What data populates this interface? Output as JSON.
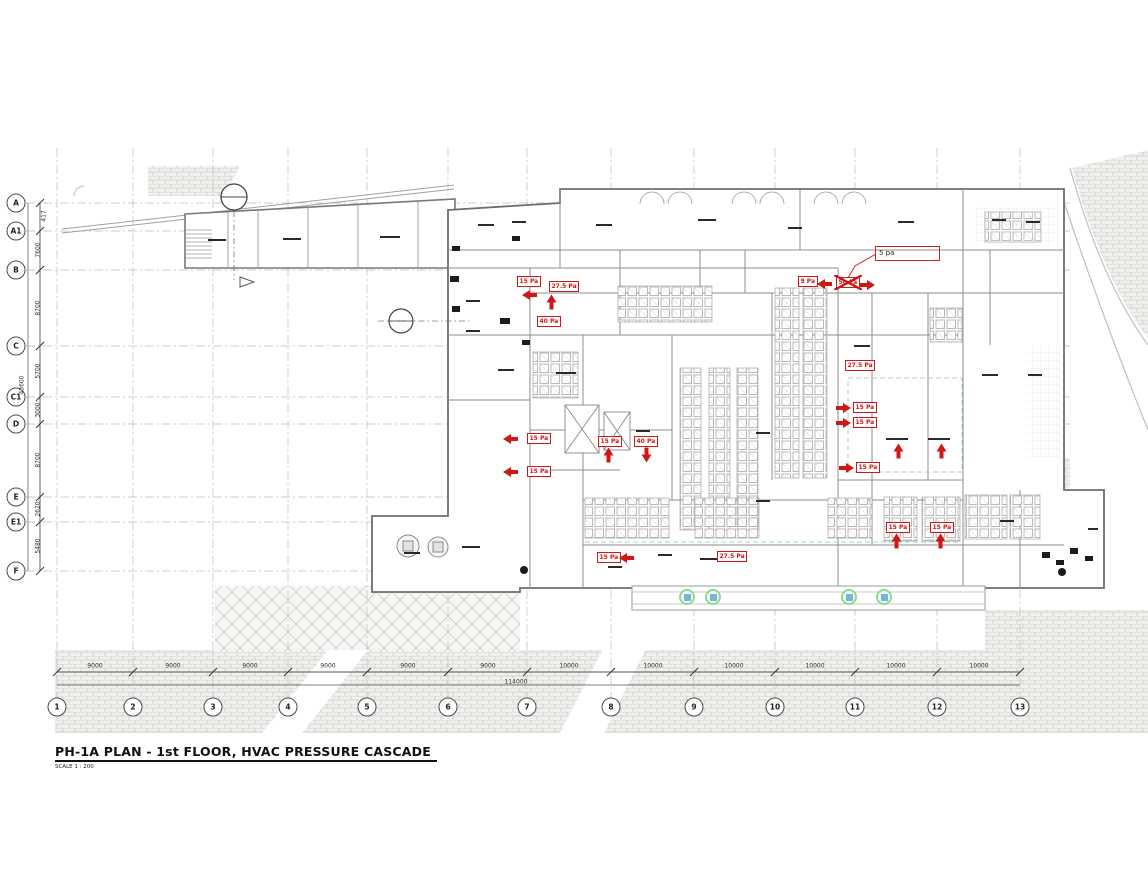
{
  "title": {
    "main": "PH-1A PLAN - 1st FLOOR, HVAC PRESSURE CASCADE",
    "scale": "SCALE 1 : 200"
  },
  "callout": {
    "text": "5 pa"
  },
  "grid": {
    "rows": [
      {
        "label": "A",
        "x": 16,
        "y": 203
      },
      {
        "label": "A1",
        "x": 16,
        "y": 231
      },
      {
        "label": "B",
        "x": 16,
        "y": 270
      },
      {
        "label": "C",
        "x": 16,
        "y": 346
      },
      {
        "label": "C1",
        "x": 16,
        "y": 397
      },
      {
        "label": "D",
        "x": 16,
        "y": 424
      },
      {
        "label": "E",
        "x": 16,
        "y": 497
      },
      {
        "label": "E1",
        "x": 16,
        "y": 522
      },
      {
        "label": "F",
        "x": 16,
        "y": 571
      }
    ],
    "cols": [
      {
        "label": "1",
        "x": 57,
        "y": 707
      },
      {
        "label": "2",
        "x": 133,
        "y": 707
      },
      {
        "label": "3",
        "x": 213,
        "y": 707
      },
      {
        "label": "4",
        "x": 288,
        "y": 707
      },
      {
        "label": "5",
        "x": 367,
        "y": 707
      },
      {
        "label": "6",
        "x": 448,
        "y": 707
      },
      {
        "label": "7",
        "x": 527,
        "y": 707
      },
      {
        "label": "8",
        "x": 611,
        "y": 707
      },
      {
        "label": "9",
        "x": 694,
        "y": 707
      },
      {
        "label": "10",
        "x": 775,
        "y": 707
      },
      {
        "label": "11",
        "x": 855,
        "y": 707
      },
      {
        "label": "12",
        "x": 937,
        "y": 707
      },
      {
        "label": "13",
        "x": 1020,
        "y": 707
      }
    ],
    "row_dims": [
      {
        "t": "417",
        "x": 44,
        "y": 216
      },
      {
        "t": "7600",
        "x": 38,
        "y": 250
      },
      {
        "t": "8700",
        "x": 38,
        "y": 308
      },
      {
        "t": "5700",
        "x": 38,
        "y": 371
      },
      {
        "t": "3000",
        "x": 38,
        "y": 410
      },
      {
        "t": "8700",
        "x": 38,
        "y": 460
      },
      {
        "t": "2620",
        "x": 38,
        "y": 509
      },
      {
        "t": "5480",
        "x": 38,
        "y": 546
      }
    ],
    "col_dims": [
      {
        "t": "9000",
        "x": 95,
        "y": 666
      },
      {
        "t": "9000",
        "x": 173,
        "y": 666
      },
      {
        "t": "9000",
        "x": 250,
        "y": 666
      },
      {
        "t": "9000",
        "x": 328,
        "y": 666
      },
      {
        "t": "9000",
        "x": 408,
        "y": 666
      },
      {
        "t": "9000",
        "x": 488,
        "y": 666
      },
      {
        "t": "10000",
        "x": 569,
        "y": 666
      },
      {
        "t": "10000",
        "x": 653,
        "y": 666
      },
      {
        "t": "10000",
        "x": 734,
        "y": 666
      },
      {
        "t": "10000",
        "x": 815,
        "y": 666
      },
      {
        "t": "10000",
        "x": 896,
        "y": 666
      },
      {
        "t": "10000",
        "x": 979,
        "y": 666
      }
    ],
    "overall_width_dim": {
      "t": "114000",
      "x": 516,
      "y": 682
    },
    "overall_height_dim": {
      "t": "43600",
      "x": 22,
      "y": 385
    }
  },
  "pressure": {
    "boxes": [
      {
        "t": "15 Pa",
        "x": 517,
        "y": 276
      },
      {
        "t": "27.5 Pa",
        "x": 549,
        "y": 281
      },
      {
        "t": "40 Pa",
        "x": 537,
        "y": 316
      },
      {
        "t": "9 Pa",
        "x": 798,
        "y": 276
      },
      {
        "t": "50 Pa",
        "x": 836,
        "y": 277,
        "cls": "crossed"
      },
      {
        "t": "15 Pa",
        "x": 598,
        "y": 436
      },
      {
        "t": "40 Pa",
        "x": 634,
        "y": 436
      },
      {
        "t": "15 Pa",
        "x": 527,
        "y": 433
      },
      {
        "t": "15 Pa",
        "x": 527,
        "y": 466
      },
      {
        "t": "27.5 Pa",
        "x": 845,
        "y": 360
      },
      {
        "t": "15 Pa",
        "x": 853,
        "y": 402
      },
      {
        "t": "15 Pa",
        "x": 853,
        "y": 417
      },
      {
        "t": "15 Pa",
        "x": 856,
        "y": 462
      },
      {
        "t": "15 Pa",
        "x": 886,
        "y": 522
      },
      {
        "t": "15 Pa",
        "x": 930,
        "y": 522
      },
      {
        "t": "15 Pa",
        "x": 597,
        "y": 552
      },
      {
        "t": "27.5 Pa",
        "x": 717,
        "y": 551
      }
    ],
    "arrows": [
      {
        "cls": "left",
        "x": 522,
        "y": 290
      },
      {
        "cls": "up",
        "x": 544,
        "y": 297
      },
      {
        "cls": "left",
        "x": 817,
        "y": 279
      },
      {
        "cls": "right",
        "x": 860,
        "y": 280
      },
      {
        "cls": "up",
        "x": 601,
        "y": 450
      },
      {
        "cls": "down",
        "x": 639,
        "y": 450
      },
      {
        "cls": "left",
        "x": 503,
        "y": 434
      },
      {
        "cls": "left",
        "x": 503,
        "y": 467
      },
      {
        "cls": "right",
        "x": 836,
        "y": 403
      },
      {
        "cls": "right",
        "x": 836,
        "y": 418
      },
      {
        "cls": "right",
        "x": 839,
        "y": 463
      },
      {
        "cls": "up",
        "x": 891,
        "y": 446
      },
      {
        "cls": "up",
        "x": 934,
        "y": 446
      },
      {
        "cls": "up",
        "x": 889,
        "y": 536
      },
      {
        "cls": "up",
        "x": 933,
        "y": 536
      },
      {
        "cls": "left",
        "x": 619,
        "y": 553
      }
    ]
  },
  "symbols": {
    "green_markers": [
      {
        "x": 687,
        "y": 597
      },
      {
        "x": 713,
        "y": 597
      },
      {
        "x": 849,
        "y": 597
      },
      {
        "x": 884,
        "y": 597
      }
    ]
  }
}
